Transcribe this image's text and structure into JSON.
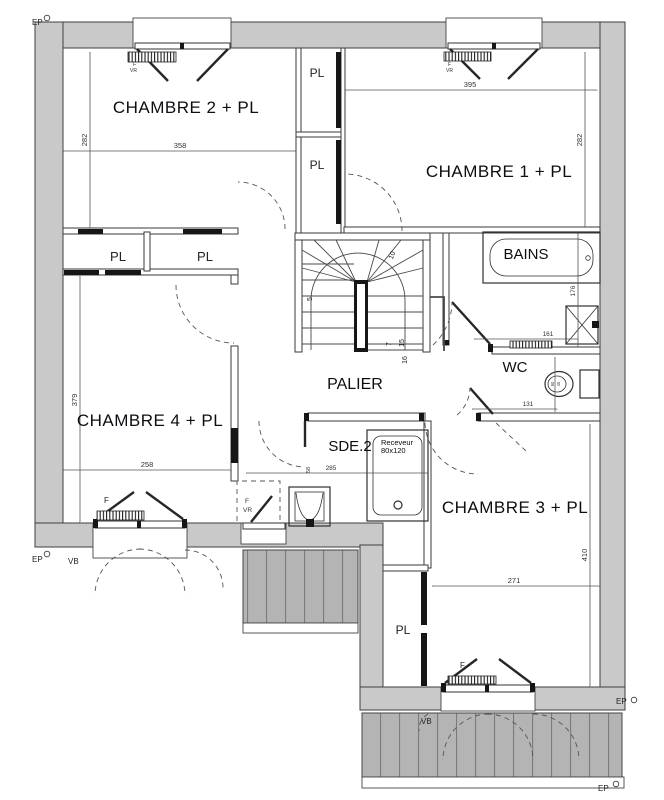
{
  "rooms": {
    "chambre1": {
      "name": "CHAMBRE 1 + PL",
      "dim_w": "395",
      "dim_h": "282"
    },
    "chambre2": {
      "name": "CHAMBRE 2 + PL",
      "dim_w": "358",
      "dim_h": "282"
    },
    "chambre3": {
      "name": "CHAMBRE 3 + PL",
      "dim_w": "271",
      "dim_h": "410"
    },
    "chambre4": {
      "name": "CHAMBRE 4 + PL",
      "dim_w": "258",
      "dim_h": "379"
    },
    "palier": {
      "name": "PALIER"
    },
    "sde2": {
      "name": "SDE.2",
      "dim_w": "285",
      "dim_small": "58",
      "shower_line1": "Receveur",
      "shower_line2": "80x120"
    },
    "bains": {
      "name": "BAINS",
      "dim_h": "176",
      "dim_w": "161"
    },
    "wc": {
      "name": "WC",
      "dim_w": "131",
      "toilet_dim1": "90",
      "toilet_dim2": "45"
    }
  },
  "closet_label": "PL",
  "stair_steps": {
    "s5": "5",
    "s7": "7",
    "s10": "10",
    "s15": "15",
    "s16": "16"
  },
  "markers": {
    "ep": "EP",
    "vb": "VB",
    "vr": "VR",
    "f": "F"
  }
}
